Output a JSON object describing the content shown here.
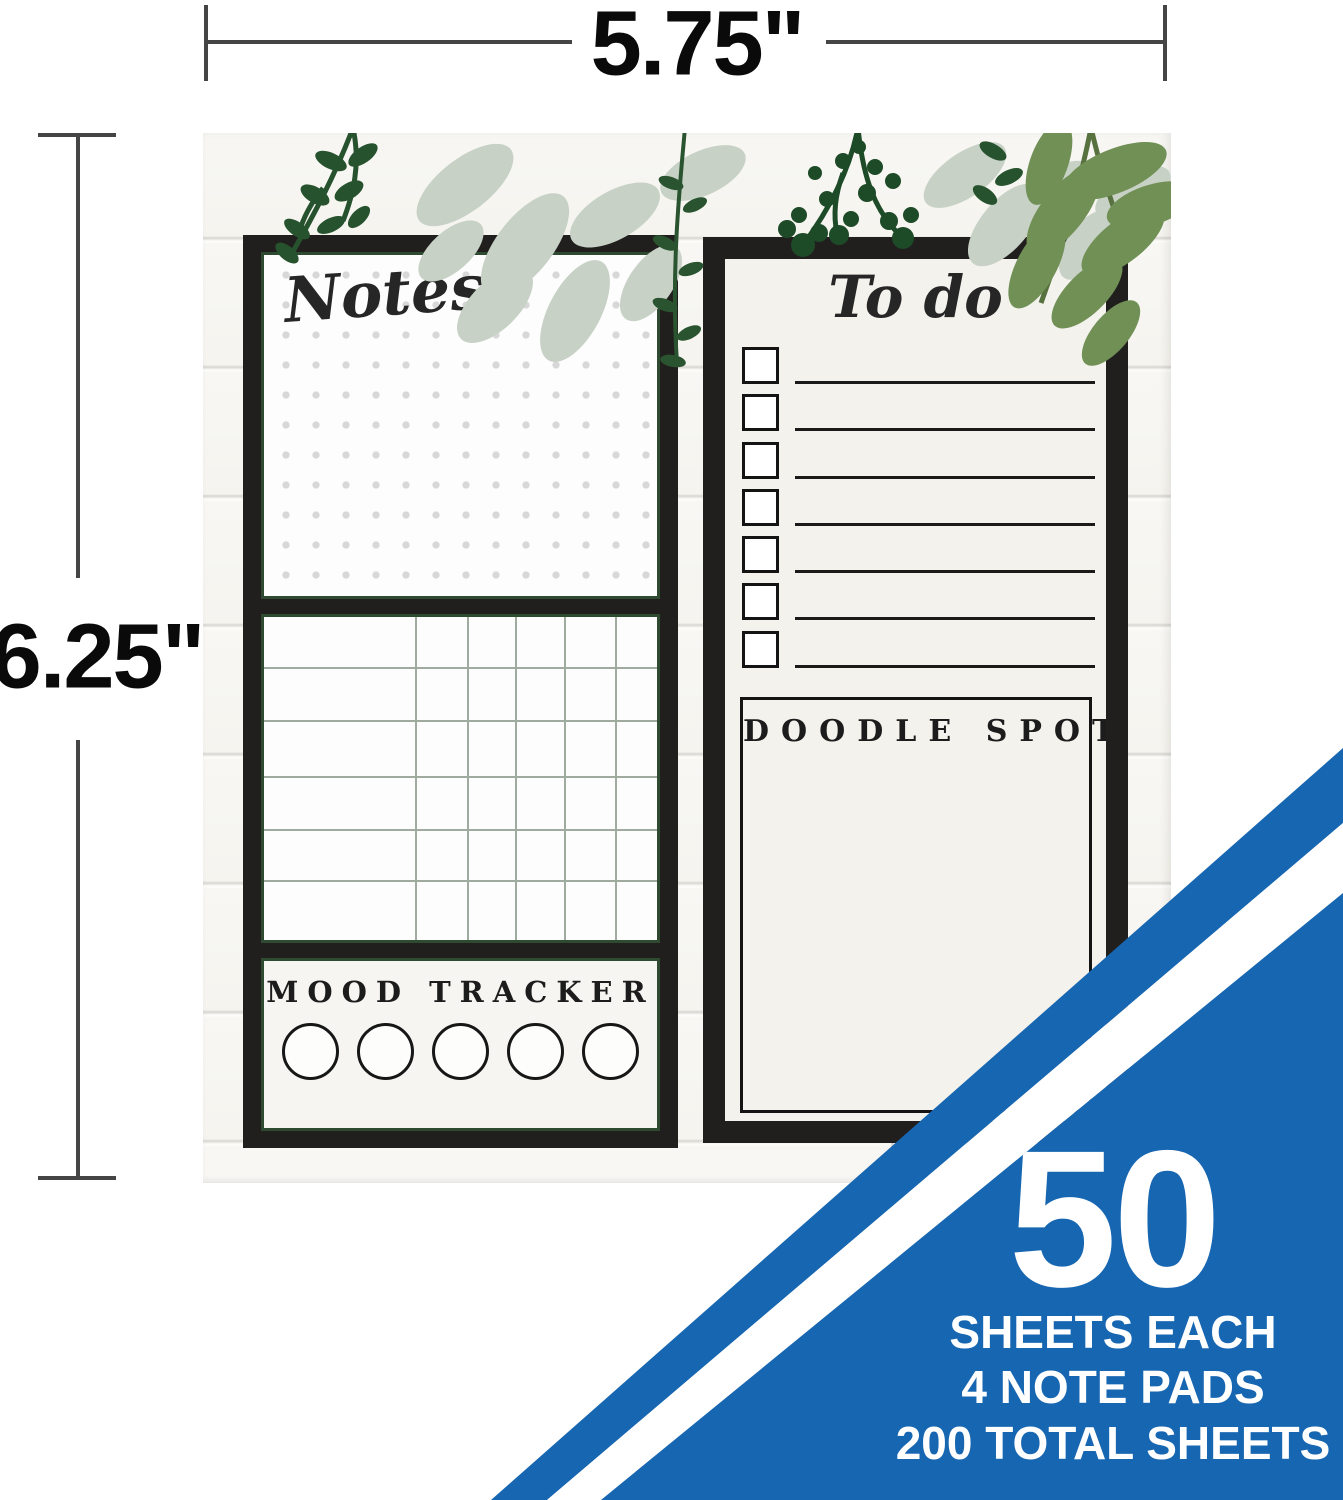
{
  "dimensions": {
    "width_label": "5.75\"",
    "height_label": "6.25\""
  },
  "left_pad": {
    "notes": {
      "title": "Notes"
    },
    "habit_grid": {
      "rows": 6,
      "columns": 6
    },
    "mood": {
      "title": "MOOD TRACKER",
      "circles": 5
    }
  },
  "right_pad": {
    "todo": {
      "title": "To do",
      "rows": 7
    },
    "doodle": {
      "title": "DOODLE SPOT"
    }
  },
  "banner": {
    "big_number": "50",
    "lines": [
      "SHEETS EACH",
      "4 NOTE PADS",
      "200 TOTAL SHEETS"
    ],
    "blue": "#1766b1"
  },
  "colors": {
    "frame_black": "#211e1e",
    "accent_green_dark": "#2e4b31",
    "foliage_dark": "#27522e",
    "foliage_medium": "#719055",
    "foliage_sage": "#c7d1c5",
    "paper_cream": "#f4f2ed",
    "grid_line": "#9fab9e"
  }
}
